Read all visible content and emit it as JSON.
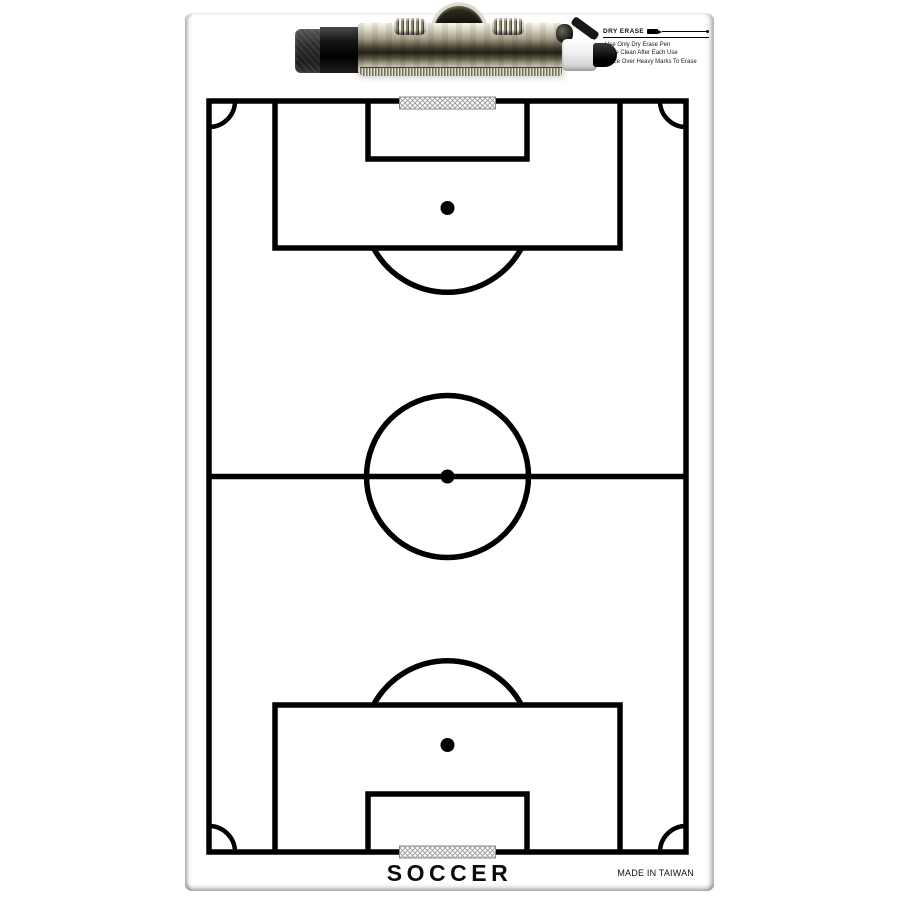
{
  "product": {
    "sport_label": "SOCCER",
    "origin_label": "MADE IN TAIWAN"
  },
  "instructions": {
    "heading": "DRY ERASE",
    "items": [
      "·Use Only Dry Erase Pen",
      "·Wipe Clean After Each Use",
      "·Trace Over Heavy Marks To Erase"
    ]
  },
  "icons": {
    "heading_icon": "dry-erase-pen-icon",
    "clip_icon": "clipboard-clip",
    "marker_icon": "dry-erase-marker"
  },
  "colors": {
    "line": "#000000",
    "board_bg": "#ffffff",
    "hatch": "#9a9a9a",
    "chrome_light": "#f4f2e7",
    "chrome_dark": "#23211a",
    "marker_black": "#141414"
  }
}
